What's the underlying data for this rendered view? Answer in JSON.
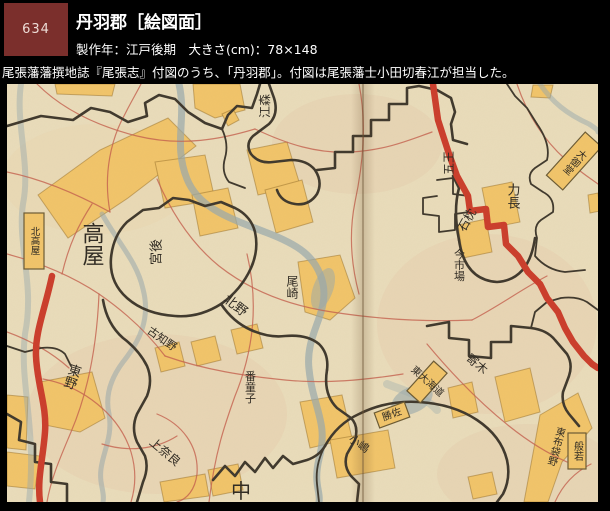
{
  "palette": {
    "page_bg": "#000000",
    "badge_bg": "#7b2f2c",
    "badge_text": "#eddcd6",
    "header_text": "#ffffff",
    "map_paper": "#e9dcba",
    "map_yellow": "#f1c469",
    "boundary": "#3f382c",
    "road_red": "#cb3d2b",
    "road_thin": "#c4604d",
    "river": "#97a8ac",
    "label_ink": "#2f2a22"
  },
  "header": {
    "badge_number": "634",
    "title": "丹羽郡［絵図面］",
    "meta": "製作年：江戸後期　大きさ(cm)：78×148",
    "description": "尾張藩藩撰地誌『尾張志』付図のうち、「丹羽郡」。付図は尾張藩士小田切春江が担当した。"
  },
  "map": {
    "alt": "丹羽郡絵図面（彩色手描き絵図）",
    "labels": [
      {
        "name": "emori",
        "text": "江森",
        "x": 258,
        "y": 22,
        "size": 12,
        "rot": -90
      },
      {
        "name": "goou",
        "text": "五王",
        "x": 442,
        "y": 79,
        "size": 12,
        "rot": -90
      },
      {
        "name": "ishimakura",
        "text": "石枕",
        "x": 460,
        "y": 136,
        "size": 12,
        "rot": -60
      },
      {
        "name": "oomido",
        "text": "大御堂",
        "x": 567,
        "y": 77,
        "size": 10,
        "rot": 42,
        "mode": "v",
        "box": true,
        "boxw": 22,
        "boxh": 58
      },
      {
        "name": "rikinaga",
        "text": "力長",
        "x": 505,
        "y": 112,
        "size": 13,
        "mode": "v"
      },
      {
        "name": "imaichiba",
        "text": "今市場",
        "x": 452,
        "y": 181,
        "size": 11,
        "mode": "v"
      },
      {
        "name": "kitatakaya",
        "text": "北高屋",
        "x": 27,
        "y": 157,
        "size": 9.5,
        "mode": "v",
        "box": true,
        "boxw": 20,
        "boxh": 56
      },
      {
        "name": "takaya",
        "text": "高屋",
        "x": 84,
        "y": 160,
        "size": 22,
        "mode": "v"
      },
      {
        "name": "miyaushiro",
        "text": "宮後",
        "x": 150,
        "y": 168,
        "size": 13,
        "rot": -90
      },
      {
        "name": "ozaki",
        "text": "尾崎",
        "x": 285,
        "y": 203,
        "size": 12,
        "mode": "v"
      },
      {
        "name": "kitano",
        "text": "北野",
        "x": 228,
        "y": 222,
        "size": 13,
        "rot": 38
      },
      {
        "name": "kochino",
        "text": "古知野",
        "x": 155,
        "y": 255,
        "size": 11,
        "rot": 35
      },
      {
        "name": "higashino",
        "text": "東野",
        "x": 64,
        "y": 292,
        "size": 13,
        "rot": 18,
        "mode": "v"
      },
      {
        "name": "kaminara",
        "text": "上奈良",
        "x": 158,
        "y": 368,
        "size": 12,
        "rot": 40
      },
      {
        "name": "bandoji",
        "text": "番童子",
        "x": 243,
        "y": 303,
        "size": 11,
        "mode": "v"
      },
      {
        "name": "naka",
        "text": "中",
        "x": 234,
        "y": 407,
        "size": 20
      },
      {
        "name": "yorigi",
        "text": "寄木",
        "x": 470,
        "y": 280,
        "size": 12,
        "rot": 40
      },
      {
        "name": "higashi-okaido",
        "text": "東大海道",
        "x": 420,
        "y": 298,
        "size": 10,
        "rot": 42,
        "box": true,
        "boxw": 18,
        "boxh": 40
      },
      {
        "name": "katsusa",
        "text": "勝佐",
        "x": 385,
        "y": 331,
        "size": 10,
        "rot": -20,
        "box": true,
        "boxw": 32,
        "boxh": 16
      },
      {
        "name": "kojima",
        "text": "小嶋",
        "x": 352,
        "y": 360,
        "size": 11,
        "rot": 35
      },
      {
        "name": "higashi-hoteino",
        "text": "東布袋野",
        "x": 548,
        "y": 362,
        "size": 10,
        "rot": 15,
        "mode": "v"
      },
      {
        "name": "hannya",
        "text": "般若",
        "x": 570,
        "y": 367,
        "size": 10,
        "mode": "v",
        "box": true,
        "boxw": 18,
        "boxh": 36
      }
    ]
  }
}
